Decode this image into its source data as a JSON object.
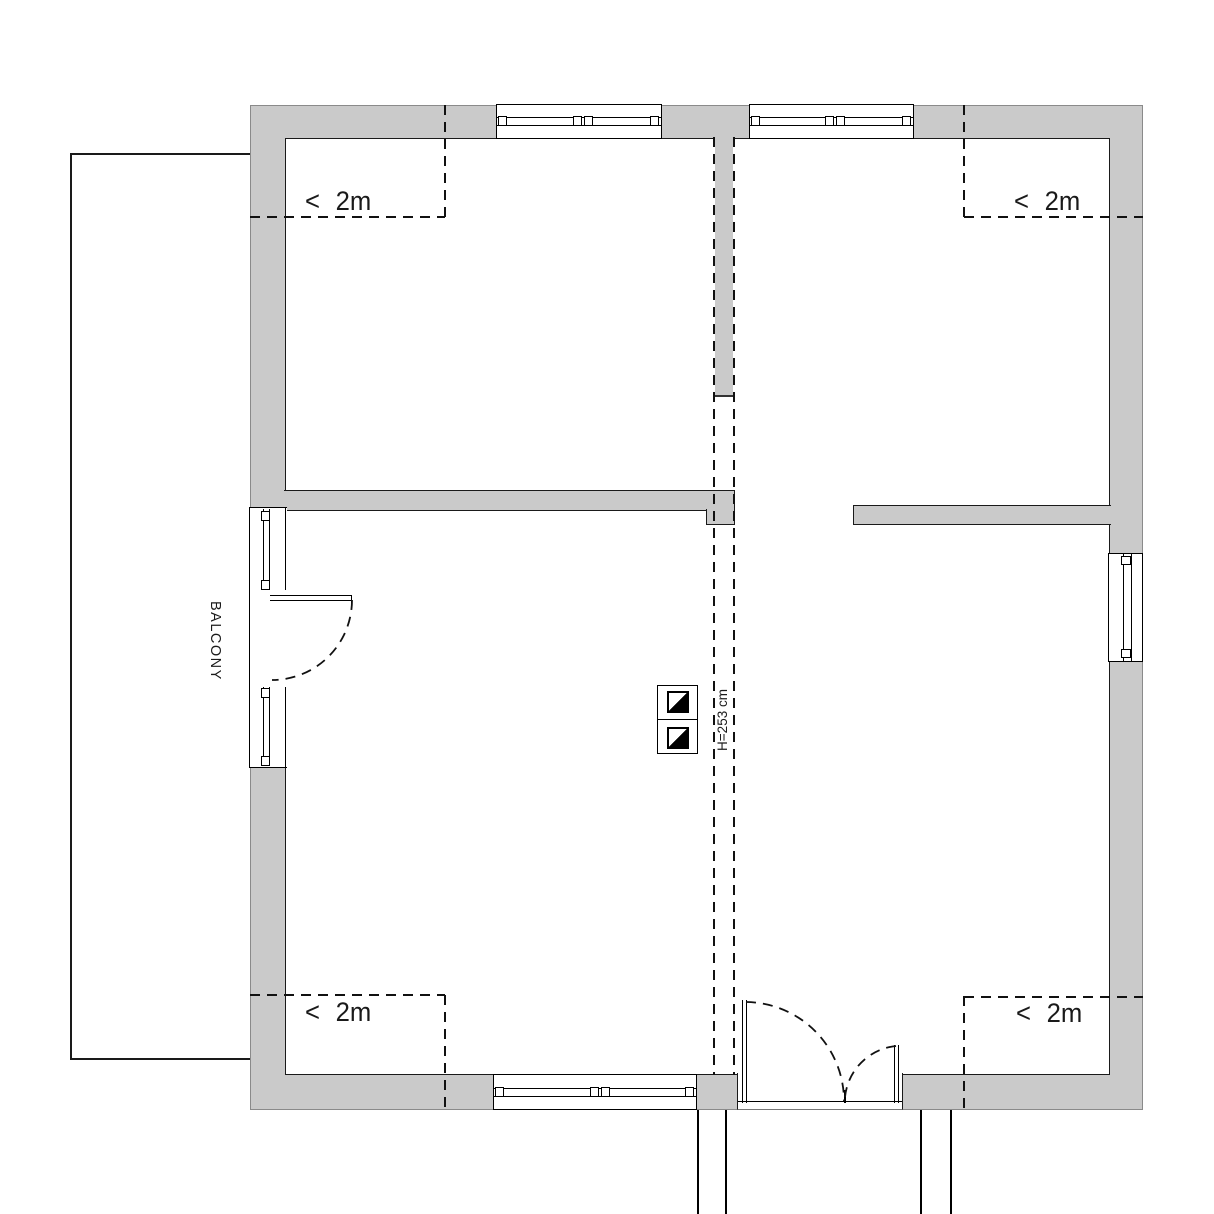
{
  "labels": {
    "headroom_top_left": "< 2m",
    "headroom_top_right": "< 2m",
    "headroom_bottom_left": "< 2m",
    "headroom_bottom_right": "< 2m",
    "balcony": "BALCONY",
    "ridge_height": "H=253 cm"
  },
  "colors": {
    "wall_fill": "#cacaca",
    "line": "#1a1a1a",
    "background": "#ffffff"
  }
}
